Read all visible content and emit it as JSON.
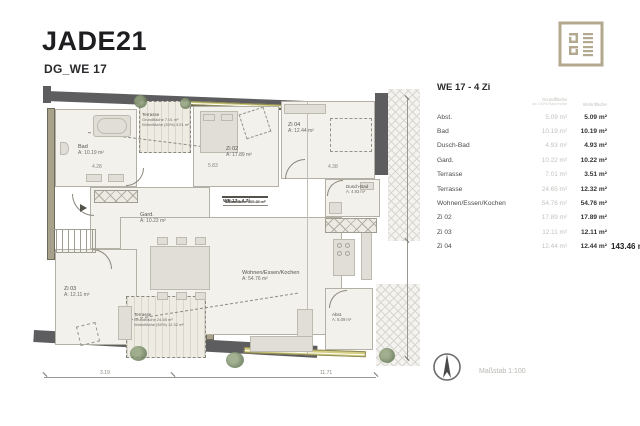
{
  "header": {
    "title": "JADE21",
    "subtitle": "DG_WE 17"
  },
  "logo": {
    "name": "jade21-brand-mark",
    "color": "#b3a98e"
  },
  "area_table": {
    "title": "WE 17 - 4 Zi",
    "col1_header": "Grundfläche",
    "col1_subheader": "ab 100% Raumhöhe",
    "col2_header": "Wohnfläche",
    "rows": [
      {
        "label": "Abst.",
        "grund": "5.09 m²",
        "wohn": "5.09 m²"
      },
      {
        "label": "Bad",
        "grund": "10.19 m²",
        "wohn": "10.19 m²"
      },
      {
        "label": "Dusch-Bad",
        "grund": "4.93 m²",
        "wohn": "4.93 m²"
      },
      {
        "label": "Gard.",
        "grund": "10.22 m²",
        "wohn": "10.22 m²"
      },
      {
        "label": "Terrasse",
        "grund": "7.01 m²",
        "wohn": "3.51 m²"
      },
      {
        "label": "Terrasse",
        "grund": "24.65 m²",
        "wohn": "12.32 m²"
      },
      {
        "label": "Wohnen/Essen/Kochen",
        "grund": "54.76 m²",
        "wohn": "54.76 m²"
      },
      {
        "label": "Zi 02",
        "grund": "17.89 m²",
        "wohn": "17.89 m²"
      },
      {
        "label": "Zi 03",
        "grund": "12.11 m²",
        "wohn": "12.11 m²"
      },
      {
        "label": "Zi 04",
        "grund": "12.44 m²",
        "wohn": "12.44 m²"
      }
    ],
    "total": "143.46 m²"
  },
  "plan": {
    "legend_box": {
      "title": "WE 17 - 4 Zi",
      "rows": [
        "Grundfläche 159.29 m²",
        "Wohnfläche 143.46 m²",
        "4 Zimmer"
      ]
    },
    "rooms": {
      "bad": {
        "name": "Bad",
        "area": "A: 10.19 m²"
      },
      "zi02": {
        "name": "Zi 02",
        "area": "A: 17.89 m²"
      },
      "zi03": {
        "name": "Zi 03",
        "area": "A: 12.11 m²"
      },
      "zi04": {
        "name": "Zi 04",
        "area": "A: 12.44 m²"
      },
      "gard": {
        "name": "Gard.",
        "area": "A: 10.22 m²"
      },
      "dusch": {
        "name": "Dusch-Bad",
        "area": "A: 4.93 m²"
      },
      "abst": {
        "name": "Abst.",
        "area": "A: 5.09 m²"
      },
      "wohnen": {
        "name": "Wohnen/Essen/Kochen",
        "area": "A: 54.76 m²"
      },
      "terrasse_top": {
        "name": "Terrasse",
        "line1": "Grundfläche 7.01 m²",
        "line2": "Wohnfläche (50%) 3.51 m²"
      },
      "terrasse_bottom": {
        "name": "Terrasse",
        "line1": "Grundfläche 24.65 m²",
        "line2": "Wohnfläche (50%) 12.32 m²"
      }
    },
    "dimensions": {
      "d1": "3.19",
      "d2": "11.71",
      "d3": "4.28",
      "d4": "5.83",
      "d5": "4.38"
    }
  },
  "footer": {
    "scale_label": "Maßstab 1:100"
  }
}
